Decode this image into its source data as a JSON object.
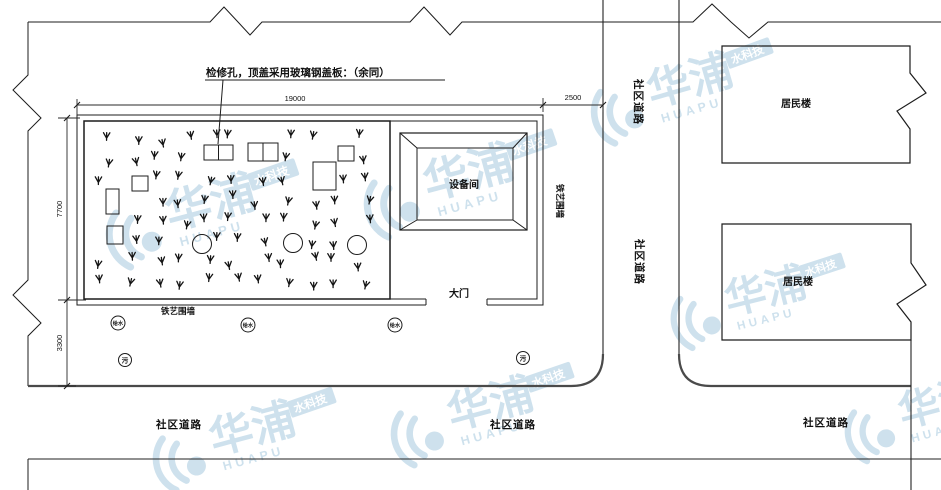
{
  "drawing": {
    "annotation": "检修孔，顶盖采用玻璃钢盖板：（余同）",
    "labels": {
      "equipment_room": "设备间",
      "main_gate": "大门",
      "iron_fence": "铁艺围墙",
      "residential_building": "居民楼",
      "community_road": "社区道路",
      "water_supply_well": "给水",
      "sewage_well": "污"
    },
    "dimensions": {
      "site_width": "19000",
      "road_offset": "2500",
      "site_height": "7700",
      "south_offset": "3300"
    },
    "watermark": {
      "cn": "华浦",
      "en": "HUAPU",
      "sub": "水科技",
      "color": "#5f9fc4"
    },
    "colors": {
      "line": "#1c1c1c",
      "road": "#4a4a4a",
      "background": "#ffffff"
    }
  },
  "grass": {
    "count": 88
  }
}
